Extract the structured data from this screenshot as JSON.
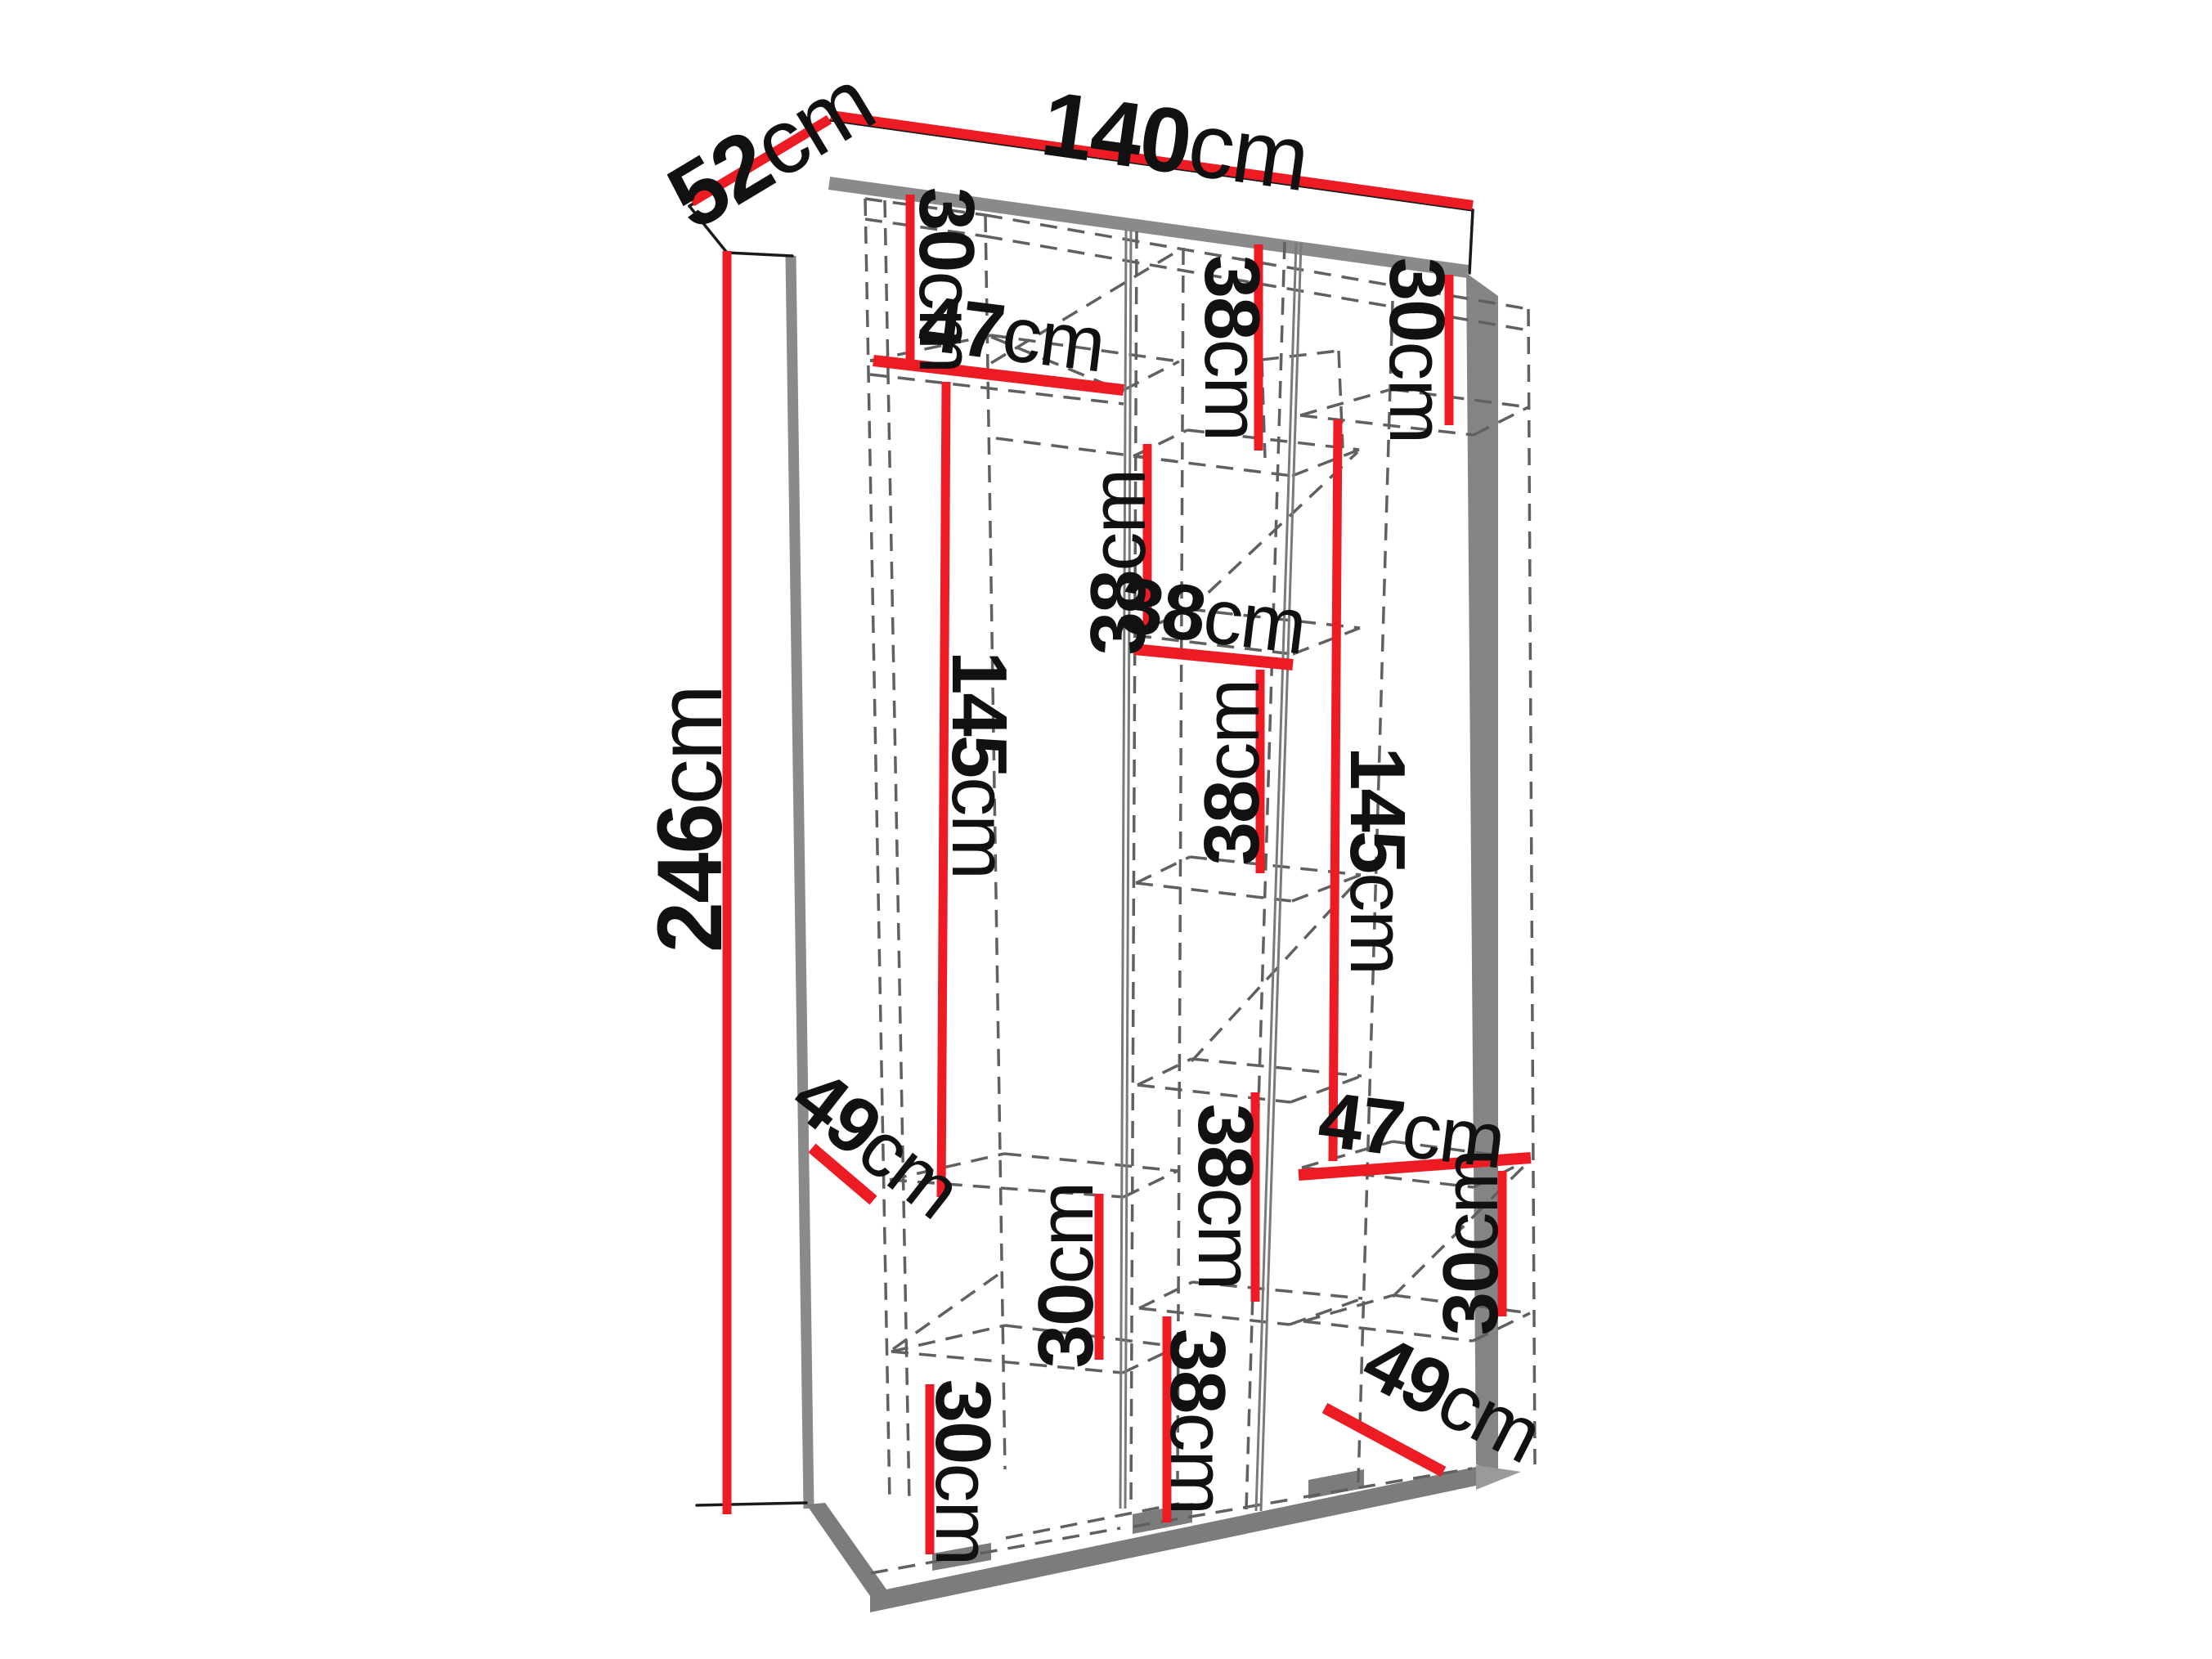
{
  "diagram": {
    "object": "wardrobe-interior-dimension-diagram",
    "unit": "cm",
    "accent_color": "#ed1c24",
    "outline_color": "#1a1a1a",
    "edge_color": "#8a8a8a",
    "dash_color": "#606060"
  },
  "overall": {
    "width": {
      "num": "140",
      "unit": "cm"
    },
    "depth": {
      "num": "52",
      "unit": "cm"
    },
    "height": {
      "num": "246",
      "unit": "cm"
    }
  },
  "left_column": {
    "top_shelf_height": {
      "num": "30",
      "unit": "cm"
    },
    "shelf_width": {
      "num": "47",
      "unit": "cm"
    },
    "hanging_height": {
      "num": "145",
      "unit": "cm"
    },
    "shelf_depth": {
      "num": "49",
      "unit": "cm"
    },
    "lower_shelf_a": {
      "num": "30",
      "unit": "cm"
    },
    "lower_shelf_b": {
      "num": "30",
      "unit": "cm"
    }
  },
  "middle_column": {
    "shelf_1": {
      "num": "38",
      "unit": "cm"
    },
    "shelf_2": {
      "num": "38",
      "unit": "cm"
    },
    "shelf_width": {
      "num": "38",
      "unit": "cm"
    },
    "shelf_3": {
      "num": "38",
      "unit": "cm"
    },
    "shelf_4": {
      "num": "38",
      "unit": "cm"
    },
    "shelf_5": {
      "num": "38",
      "unit": "cm"
    }
  },
  "right_column": {
    "top_shelf_height": {
      "num": "30",
      "unit": "cm"
    },
    "hanging_height": {
      "num": "145",
      "unit": "cm"
    },
    "shelf_width": {
      "num": "47",
      "unit": "cm"
    },
    "lower_shelf": {
      "num": "30",
      "unit": "cm"
    },
    "shelf_depth": {
      "num": "49",
      "unit": "cm"
    }
  }
}
